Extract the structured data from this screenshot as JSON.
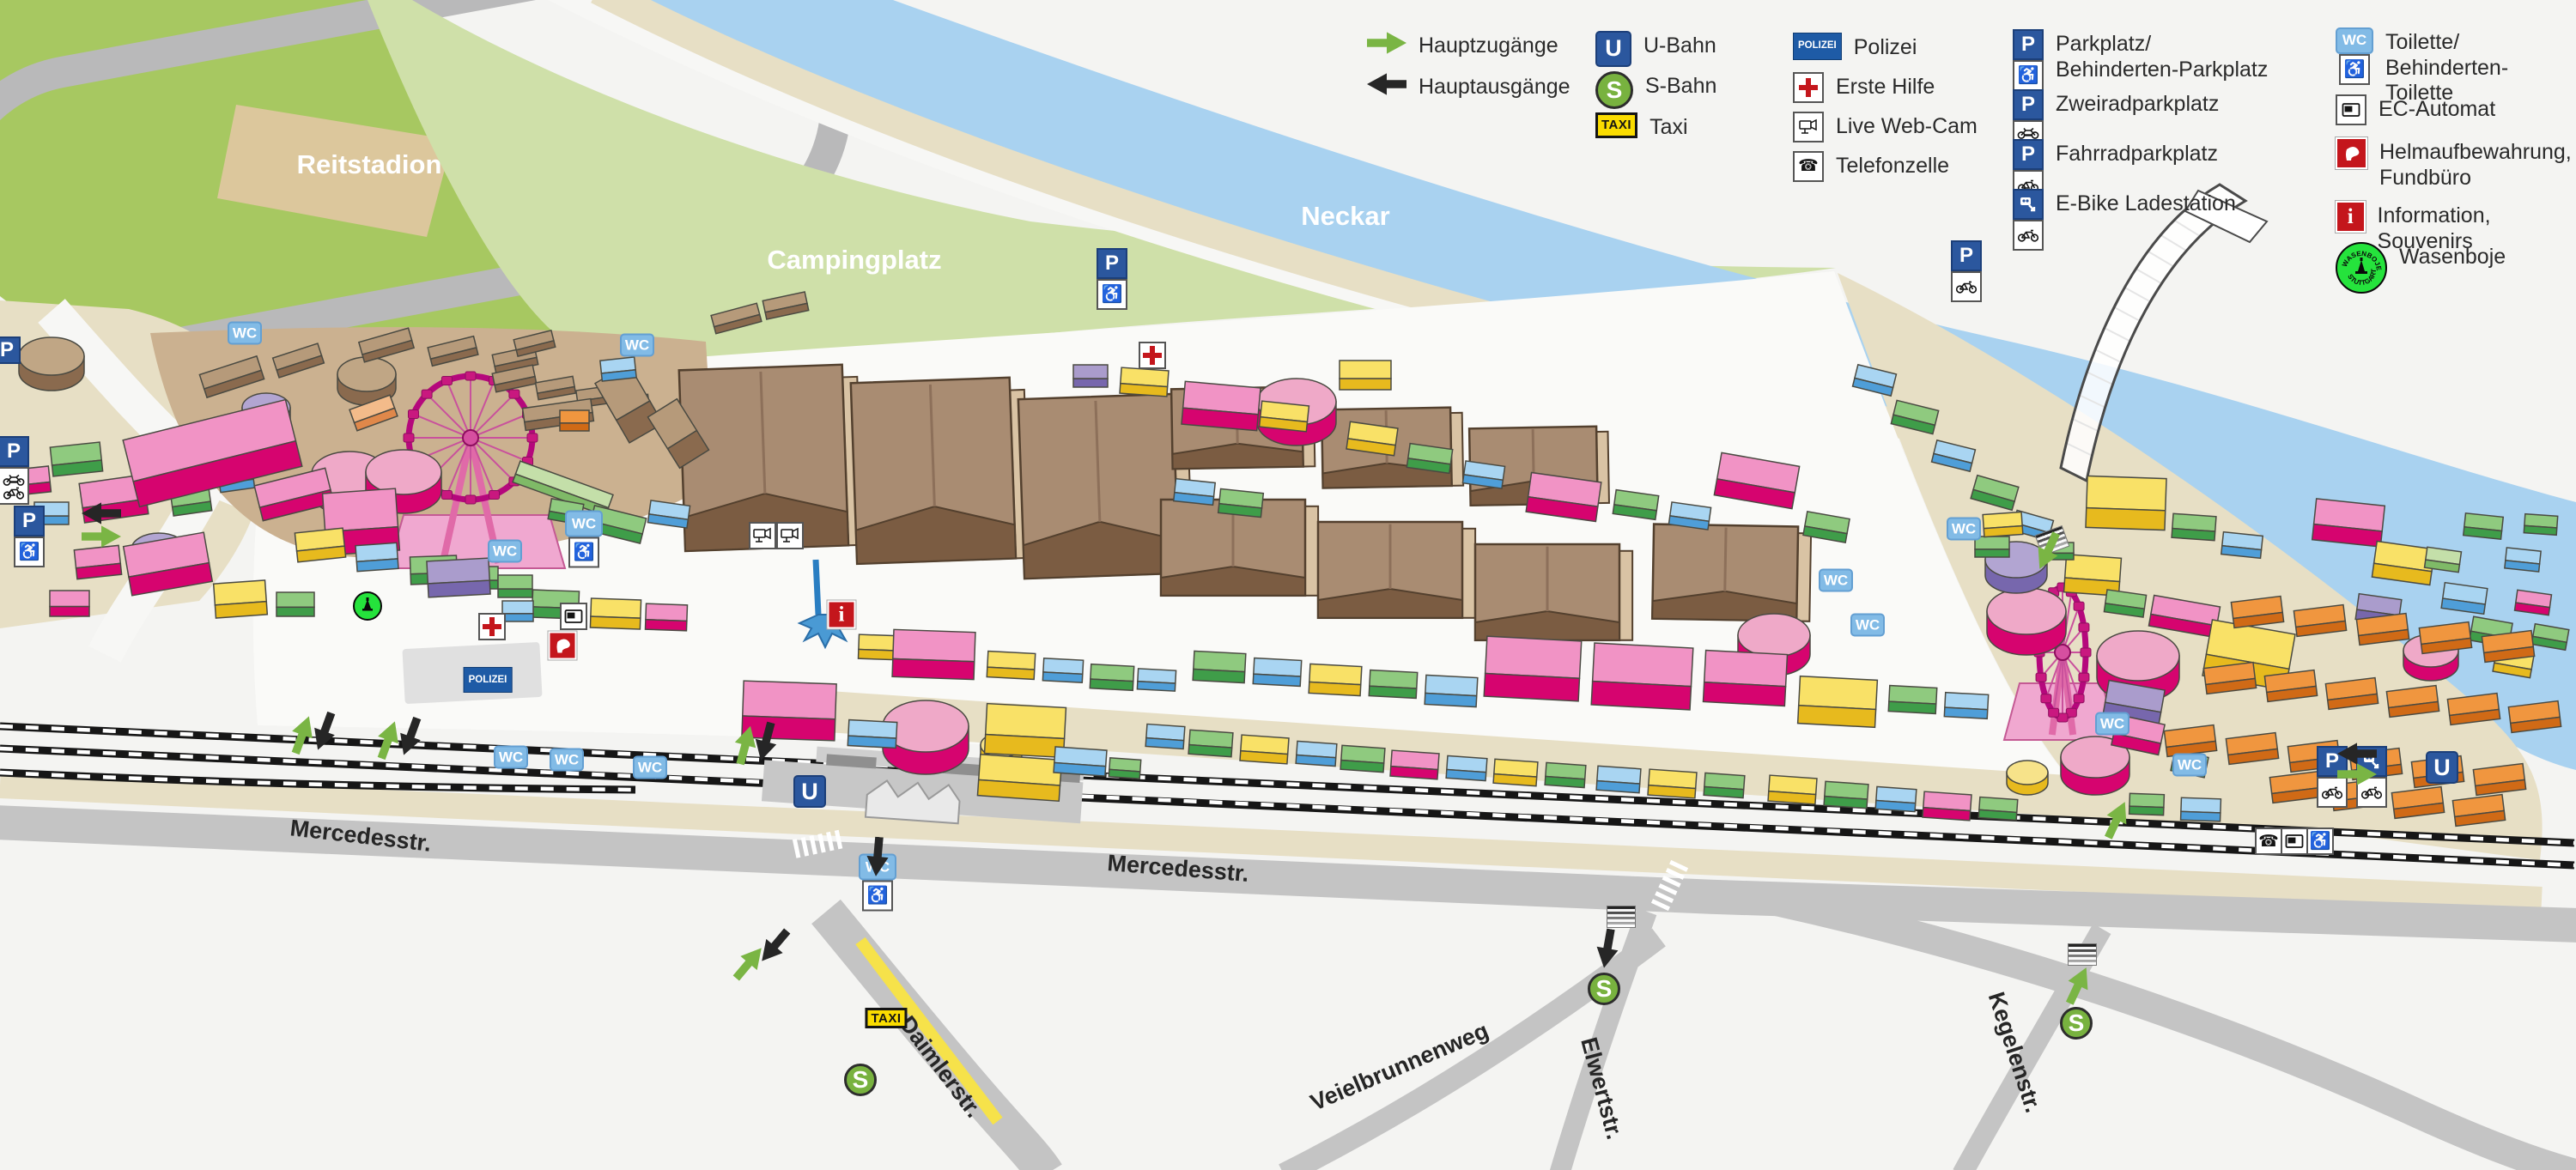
{
  "legend": {
    "columns": [
      {
        "items": [
          {
            "icon": "arrow-green",
            "label": "Hauptzugänge"
          },
          {
            "icon": "arrow-black",
            "label": "Hauptausgänge"
          }
        ]
      },
      {
        "items": [
          {
            "icon": "u-bahn",
            "label": "U-Bahn"
          },
          {
            "icon": "s-bahn",
            "label": "S-Bahn"
          },
          {
            "icon": "taxi",
            "label": "Taxi"
          }
        ]
      },
      {
        "items": [
          {
            "icon": "polizei",
            "label": "Polizei"
          },
          {
            "icon": "erste-hilfe",
            "label": "Erste Hilfe"
          },
          {
            "icon": "webcam",
            "label": "Live Web-Cam"
          },
          {
            "icon": "telefonzelle",
            "label": "Telefonzelle"
          }
        ]
      },
      {
        "items": [
          {
            "icon": "parkplatz-behinderten",
            "label": "Parkplatz/\nBehinderten-Parkplatz"
          },
          {
            "icon": "zweirad",
            "label": "Zweiradparkplatz"
          },
          {
            "icon": "fahrrad",
            "label": "Fahrradparkplatz"
          },
          {
            "icon": "ebike",
            "label": "E-Bike Ladestation"
          }
        ]
      },
      {
        "items": [
          {
            "icon": "toilette-behinderten",
            "label": "Toilette/\nBehinderten-Toilette"
          },
          {
            "icon": "ec-automat",
            "label": "EC-Automat"
          },
          {
            "icon": "helm",
            "label": "Helmaufbewahrung,\nFundbüro"
          },
          {
            "icon": "information",
            "label": "Information, Souvenirs"
          },
          {
            "icon": "wasenboje",
            "label": "Wasenboje"
          }
        ]
      }
    ]
  },
  "map_labels": {
    "reitstadion": "Reitstadion",
    "campingplatz": "Campingplatz",
    "neckar": "Neckar",
    "mercedesstr": "Mercedesstr.",
    "daimlerstr": "Daimlerstr.",
    "veielbrunnenweg": "Veielbrunnenweg",
    "elwertstr": "Elwertstr.",
    "kegelenstr": "Kegelenstr."
  },
  "badges": {
    "u": "U",
    "s": "S",
    "taxi": "TAXI",
    "polizei": "POLIZEI",
    "wc": "WC",
    "p": "P",
    "info": "i",
    "wasenboje_top": "WASENBOJE",
    "wasenboje_bottom": "STUTTGART"
  },
  "colors": {
    "river": "#a9d2f0",
    "grass": "#a7c861",
    "camping": "#cfe0a9",
    "sand": "#e7dfc5",
    "fairground_tan": "#cbb190",
    "road": "#c4c4c4",
    "tent_roof": "#a98c72",
    "tent_front": "#7b5c42",
    "booth_pink": "#d6046f",
    "booth_yellow": "#e7ba1e",
    "booth_green": "#3f9d49",
    "booth_blue": "#4f9ed8",
    "booth_purple": "#7767ad",
    "booth_orange": "#d06a16",
    "u_bahn_blue": "#2b579e",
    "s_bahn_green": "#78b23f",
    "taxi_yellow": "#fadc00",
    "police_blue": "#1e5ba6",
    "red": "#c4161c",
    "wc_blue": "#82bbe6",
    "wasenboje_green": "#25e33c"
  }
}
